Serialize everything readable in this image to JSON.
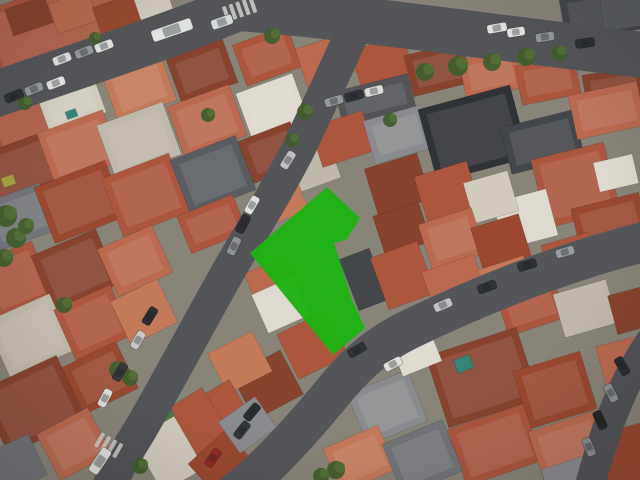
{
  "meta": {
    "view": "oblique-aerial-satellite-photo",
    "description": "Dense urban neighborhood with terracotta roofs, curving streets and a highlighted parcel polygon"
  },
  "map": {
    "background": "#8d897e",
    "tint": "rgba(50,40,28,0.05)",
    "palette": {
      "r1": "#a04a32",
      "r2": "#b35941",
      "r3": "#c26e54",
      "r4": "#8c4530",
      "r5": "#cc7e5d",
      "w1": "#d9d4c7",
      "w2": "#e8e4da",
      "w3": "#c7c1b4",
      "g1": "#5b5f65",
      "g2": "#44484e",
      "g3": "#2f3339",
      "g4": "#75797f",
      "g5": "#8e9196",
      "sx": "#54575c",
      "t1": "#35897d",
      "y1": "#aaa845",
      "vr": "#4f7f3f"
    },
    "tree_color": "#42602f",
    "tree_color2": "#55743a",
    "streets": [
      {
        "name": "top-avenue",
        "path": "M -15,98 C 70,68 160,40 238,8 C 330,14 480,36 652,56",
        "w": 46,
        "c": "#55585d"
      },
      {
        "name": "central-street",
        "path": "M 362,12 C 342,55 322,100 298,150 C 272,200 252,230 228,272 C 198,325 168,382 140,430 C 128,450 118,464 106,494",
        "w": 34,
        "c": "#54575c"
      },
      {
        "name": "lower-street",
        "path": "M 652,240 C 560,262 470,300 408,330 C 378,345 358,362 338,386 C 312,418 285,448 262,470 C 252,480 244,486 232,496",
        "w": 40,
        "c": "#56595e"
      },
      {
        "name": "right-street",
        "path": "M 657,333 C 628,370 605,425 588,494",
        "w": 30,
        "c": "#53565b"
      }
    ],
    "blocks": [
      [
        -15,
        -15,
        160,
        70,
        "r2",
        -19
      ],
      [
        8,
        2,
        42,
        28,
        "r4",
        -19
      ],
      [
        52,
        -4,
        42,
        32,
        "r3",
        -19
      ],
      [
        96,
        0,
        42,
        30,
        "r1",
        -19
      ],
      [
        136,
        -10,
        34,
        26,
        "w1",
        -19
      ],
      [
        262,
        -12,
        58,
        38,
        "r2",
        -18
      ],
      [
        318,
        -8,
        70,
        40,
        "g2",
        -16
      ],
      [
        562,
        -10,
        85,
        45,
        "g2",
        -10
      ],
      [
        602,
        -4,
        48,
        32,
        "g1",
        -8
      ],
      [
        -12,
        88,
        80,
        60,
        "r2",
        -20
      ],
      [
        -15,
        142,
        70,
        55,
        "r4",
        -20
      ],
      [
        -12,
        192,
        62,
        50,
        "g4",
        -20
      ],
      [
        40,
        76,
        60,
        48,
        "w1",
        -20
      ],
      [
        44,
        120,
        70,
        55,
        "r3",
        -20
      ],
      [
        42,
        172,
        76,
        60,
        "r1",
        -21
      ],
      [
        108,
        62,
        62,
        50,
        "r5",
        -20
      ],
      [
        104,
        112,
        70,
        56,
        "w3",
        -20
      ],
      [
        110,
        164,
        72,
        62,
        "r2",
        -21
      ],
      [
        172,
        48,
        60,
        46,
        "r4",
        -20
      ],
      [
        174,
        94,
        66,
        54,
        "r3",
        -20
      ],
      [
        178,
        146,
        70,
        58,
        "g1",
        -21
      ],
      [
        182,
        204,
        60,
        40,
        "r2",
        -22
      ],
      [
        238,
        34,
        58,
        44,
        "r2",
        -20
      ],
      [
        242,
        82,
        60,
        48,
        "w2",
        -20
      ],
      [
        244,
        130,
        56,
        45,
        "r4",
        -21
      ],
      [
        292,
        148,
        44,
        38,
        "w3",
        -20
      ],
      [
        262,
        184,
        42,
        35,
        "r5",
        -22
      ],
      [
        300,
        40,
        52,
        40,
        "r3",
        -18
      ],
      [
        355,
        42,
        55,
        40,
        "r2",
        -16
      ],
      [
        408,
        48,
        60,
        42,
        "r4",
        -14
      ],
      [
        462,
        54,
        58,
        40,
        "r3",
        -12
      ],
      [
        518,
        60,
        60,
        40,
        "r2",
        -11
      ],
      [
        585,
        70,
        60,
        42,
        "r4",
        -10
      ],
      [
        338,
        82,
        75,
        36,
        "sx",
        -14
      ],
      [
        315,
        118,
        55,
        42,
        "r2",
        -18
      ],
      [
        368,
        112,
        60,
        45,
        "g5",
        -16
      ],
      [
        426,
        96,
        95,
        75,
        "g3",
        -15
      ],
      [
        505,
        118,
        75,
        48,
        "g2",
        -14
      ],
      [
        572,
        88,
        70,
        45,
        "r3",
        -12
      ],
      [
        538,
        150,
        75,
        70,
        "r2",
        -14
      ],
      [
        596,
        158,
        40,
        30,
        "w2",
        -13
      ],
      [
        575,
        200,
        70,
        45,
        "r1",
        -14
      ],
      [
        498,
        195,
        55,
        48,
        "w2",
        -15
      ],
      [
        545,
        238,
        50,
        38,
        "r2",
        -16
      ],
      [
        370,
        160,
        55,
        48,
        "r4",
        -17
      ],
      [
        420,
        168,
        55,
        50,
        "r2",
        -17
      ],
      [
        468,
        176,
        46,
        42,
        "w1",
        -16
      ],
      [
        378,
        208,
        48,
        42,
        "r4",
        -18
      ],
      [
        424,
        215,
        56,
        48,
        "r3",
        -18
      ],
      [
        476,
        220,
        50,
        45,
        "r1",
        -17
      ],
      [
        348,
        252,
        32,
        55,
        "g2",
        -21
      ],
      [
        378,
        248,
        50,
        55,
        "r2",
        -20
      ],
      [
        428,
        262,
        55,
        48,
        "r3",
        -19
      ],
      [
        482,
        262,
        48,
        36,
        "r5",
        -18
      ],
      [
        252,
        262,
        48,
        50,
        "r3",
        -24
      ],
      [
        258,
        284,
        45,
        42,
        "w2",
        -24
      ],
      [
        285,
        320,
        55,
        50,
        "r2",
        -26
      ],
      [
        240,
        360,
        55,
        50,
        "r4",
        -28
      ],
      [
        215,
        340,
        50,
        45,
        "r5",
        -27
      ],
      [
        190,
        390,
        55,
        48,
        "r2",
        -30
      ],
      [
        172,
        396,
        48,
        55,
        "r2",
        -32
      ],
      [
        142,
        415,
        48,
        70,
        "w1",
        -30
      ],
      [
        152,
        406,
        20,
        16,
        "vr",
        -30
      ],
      [
        195,
        442,
        50,
        40,
        "r1",
        -42
      ],
      [
        225,
        406,
        45,
        38,
        "g5",
        -35
      ],
      [
        -15,
        250,
        60,
        60,
        "r2",
        -22
      ],
      [
        40,
        240,
        70,
        60,
        "r4",
        -23
      ],
      [
        105,
        235,
        60,
        52,
        "r3",
        -24
      ],
      [
        -5,
        305,
        70,
        62,
        "w3",
        -24
      ],
      [
        62,
        295,
        62,
        55,
        "r2",
        -24
      ],
      [
        118,
        288,
        52,
        48,
        "r5",
        -26
      ],
      [
        -10,
        370,
        85,
        70,
        "r4",
        -25
      ],
      [
        70,
        352,
        60,
        52,
        "r1",
        -26
      ],
      [
        45,
        418,
        58,
        52,
        "r3",
        -28
      ],
      [
        -8,
        442,
        48,
        45,
        "g4",
        -25
      ],
      [
        500,
        280,
        60,
        48,
        "r2",
        -18
      ],
      [
        558,
        286,
        55,
        45,
        "w3",
        -16
      ],
      [
        612,
        290,
        40,
        40,
        "r4",
        -15
      ],
      [
        435,
        340,
        95,
        75,
        "r4",
        -18
      ],
      [
        520,
        360,
        70,
        60,
        "r1",
        -17
      ],
      [
        455,
        415,
        80,
        60,
        "r2",
        -19
      ],
      [
        535,
        420,
        70,
        55,
        "r3",
        -18
      ],
      [
        355,
        380,
        65,
        55,
        "g5",
        -22
      ],
      [
        330,
        435,
        60,
        48,
        "r5",
        -24
      ],
      [
        390,
        430,
        65,
        55,
        "g4",
        -22
      ],
      [
        395,
        335,
        42,
        35,
        "w2",
        -22
      ],
      [
        600,
        340,
        50,
        40,
        "r3",
        -14
      ],
      [
        598,
        428,
        55,
        55,
        "r1",
        -15
      ],
      [
        545,
        462,
        45,
        35,
        "g5",
        -18
      ],
      [
        66,
        110,
        11,
        8,
        "t1",
        -20
      ],
      [
        455,
        357,
        17,
        14,
        "t1",
        -22
      ],
      [
        2,
        176,
        13,
        10,
        "y1",
        -20
      ]
    ],
    "vegetation": [
      [
        425,
        72,
        9
      ],
      [
        458,
        66,
        10
      ],
      [
        492,
        62,
        9
      ],
      [
        526,
        57,
        9
      ],
      [
        559,
        53,
        8
      ],
      [
        305,
        112,
        8
      ],
      [
        292,
        140,
        7
      ],
      [
        272,
        36,
        8
      ],
      [
        208,
        115,
        7
      ],
      [
        6,
        216,
        11
      ],
      [
        16,
        238,
        10
      ],
      [
        4,
        258,
        9
      ],
      [
        26,
        226,
        8
      ],
      [
        64,
        305,
        8
      ],
      [
        118,
        370,
        9
      ],
      [
        130,
        378,
        8
      ],
      [
        336,
        470,
        9
      ],
      [
        321,
        476,
        8
      ],
      [
        25,
        103,
        7
      ],
      [
        95,
        38,
        6
      ],
      [
        390,
        120,
        7
      ],
      [
        140,
        466,
        8
      ]
    ],
    "cars": [
      [
        172,
        30,
        -19,
        "#e9ebec",
        42,
        12
      ],
      [
        222,
        22,
        -19,
        "#dfe3e4",
        22,
        10
      ],
      [
        14,
        96,
        -22,
        "#2f3338"
      ],
      [
        34,
        89,
        -22,
        "#9aa0a5"
      ],
      [
        56,
        83,
        -21,
        "#eef0f0"
      ],
      [
        62,
        59,
        -21,
        "#e8eaea"
      ],
      [
        84,
        52,
        -21,
        "#9ba0a5"
      ],
      [
        104,
        46,
        -21,
        "#eceeee"
      ],
      [
        497,
        28,
        -10,
        "#eceeee",
        20,
        9
      ],
      [
        516,
        32,
        -9,
        "#f0f1f1",
        18,
        9
      ],
      [
        545,
        37,
        -9,
        "#9aa0a5"
      ],
      [
        585,
        43,
        -8,
        "#2e3238"
      ],
      [
        334,
        101,
        -16,
        "#9b9fa4"
      ],
      [
        354,
        96,
        -15,
        "#30343a"
      ],
      [
        374,
        91,
        -14,
        "#e6e6e4"
      ],
      [
        288,
        160,
        -58,
        "#c6c9cb"
      ],
      [
        252,
        205,
        -60,
        "#e9eaea"
      ],
      [
        243,
        224,
        -62,
        "#2d3036"
      ],
      [
        234,
        246,
        -64,
        "#95999e"
      ],
      [
        150,
        316,
        -58,
        "#2c2f35"
      ],
      [
        138,
        340,
        -60,
        "#cfd1d2"
      ],
      [
        120,
        372,
        -60,
        "#34383e"
      ],
      [
        105,
        398,
        -62,
        "#e8e8e6"
      ],
      [
        100,
        461,
        -56,
        "#e9e9e7",
        28,
        11
      ],
      [
        527,
        265,
        -17,
        "#2e3238"
      ],
      [
        565,
        252,
        -16,
        "#9fa3a8"
      ],
      [
        487,
        287,
        -20,
        "#2f3339"
      ],
      [
        443,
        305,
        -23,
        "#caccce"
      ],
      [
        393,
        364,
        -28,
        "#eceae6"
      ],
      [
        357,
        350,
        -30,
        "#2f3339"
      ],
      [
        242,
        430,
        -52,
        "#33373d"
      ],
      [
        252,
        412,
        -50,
        "#2a2e33"
      ],
      [
        213,
        458,
        -55,
        "#9e2b24"
      ],
      [
        622,
        366,
        60,
        "#2b2e34"
      ],
      [
        611,
        393,
        63,
        "#94989d"
      ],
      [
        600,
        420,
        65,
        "#24272d"
      ],
      [
        589,
        447,
        67,
        "#8e9297"
      ]
    ],
    "crosswalks": [
      {
        "x": 241,
        "y": 9,
        "rot": -19,
        "n": 5
      },
      {
        "x": 110,
        "y": 446,
        "rot": 30,
        "n": 4
      }
    ]
  },
  "parcel": {
    "points": "327,187 360,218 346,240 334,243 352,300 365,328 333,355 250,253",
    "fill": "#1eb212",
    "opacity": 0.97
  }
}
